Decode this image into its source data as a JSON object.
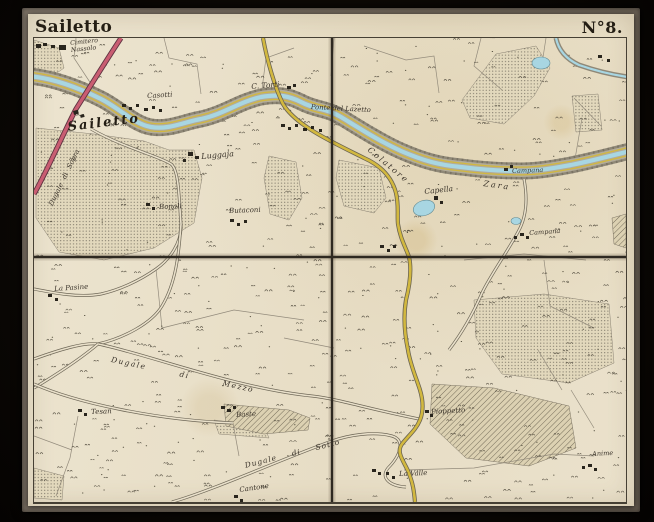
{
  "header": {
    "title": "Sailetto",
    "sheet_number": "N°8."
  },
  "map": {
    "colors": {
      "paper": "#e9e0ca",
      "water": "#a8d6e2",
      "main_road": "#c95d72",
      "secondary_road": "#d2b83f",
      "embankment": "#8f8877",
      "ink": "#3a332a",
      "frame": "#6d6357",
      "background": "#090704"
    },
    "labels": [
      {
        "id": "cimitero-nassolo",
        "text": "Cimitero\nNassolo",
        "x": 36,
        "y": 3,
        "size": 6.3,
        "rot": -6
      },
      {
        "id": "casotti",
        "text": "Casotti",
        "x": 113,
        "y": 55,
        "size": 7,
        "rot": -3
      },
      {
        "id": "c-torti",
        "text": "C. Torti",
        "x": 217,
        "y": 45,
        "size": 7.5,
        "rot": -5
      },
      {
        "id": "ponte-del-lazetto",
        "text": "Ponte del Lazetto",
        "x": 277,
        "y": 66,
        "size": 6.8,
        "rot": 3
      },
      {
        "id": "sailetto-town",
        "text": "Sailetto",
        "x": 33,
        "y": 83,
        "size": 13,
        "rot": -7,
        "bold": true,
        "ls": 2
      },
      {
        "id": "dugale-di-sopra",
        "text": "Dugale di Sopra",
        "x": 14,
        "y": 166,
        "size": 6.8,
        "rot": -64,
        "ws": 3
      },
      {
        "id": "luggaja",
        "text": "Luggaja",
        "x": 167,
        "y": 115,
        "size": 8,
        "rot": -5
      },
      {
        "id": "bonali",
        "text": "Bonali",
        "x": 125,
        "y": 166,
        "size": 7,
        "rot": -2
      },
      {
        "id": "butaconi",
        "text": "Butaconi",
        "x": 195,
        "y": 170,
        "size": 7,
        "rot": -2
      },
      {
        "id": "colatore",
        "text": "Colatore",
        "x": 337,
        "y": 108,
        "size": 8,
        "rot": 40,
        "ls": 2
      },
      {
        "id": "zara",
        "text": "Zara",
        "x": 450,
        "y": 142,
        "size": 8,
        "rot": 8,
        "ls": 2
      },
      {
        "id": "capella",
        "text": "Capella",
        "x": 390,
        "y": 150,
        "size": 7.5,
        "rot": -6
      },
      {
        "id": "campana-north",
        "text": "Campana",
        "x": 478,
        "y": 130,
        "size": 6.5,
        "rot": -2
      },
      {
        "id": "campana-south",
        "text": "Campana",
        "x": 495,
        "y": 192,
        "size": 6.5,
        "rot": -4
      },
      {
        "id": "la-pasine",
        "text": "La Pasine",
        "x": 20,
        "y": 248,
        "size": 7,
        "rot": -4
      },
      {
        "id": "dugale-di-mezzo",
        "text": "Dugale di Mezzo",
        "x": 78,
        "y": 318,
        "size": 7.5,
        "rot": 12,
        "ws": 30,
        "ls": 1.5
      },
      {
        "id": "tesan",
        "text": "Tesan",
        "x": 57,
        "y": 371,
        "size": 7,
        "rot": -2
      },
      {
        "id": "baste",
        "text": "Baste",
        "x": 202,
        "y": 374,
        "size": 7,
        "rot": -3
      },
      {
        "id": "pioppetto",
        "text": "Pioppetto",
        "x": 397,
        "y": 371,
        "size": 7,
        "rot": -3
      },
      {
        "id": "la-valle",
        "text": "La Valle",
        "x": 365,
        "y": 433,
        "size": 7,
        "rot": -2
      },
      {
        "id": "anime",
        "text": "Anime",
        "x": 558,
        "y": 413,
        "size": 6.5,
        "rot": -3
      },
      {
        "id": "cantone",
        "text": "Cantone",
        "x": 205,
        "y": 449,
        "size": 7,
        "rot": -8
      },
      {
        "id": "dugale-di-sotto",
        "text": "Dugale di Sotto",
        "x": 210,
        "y": 424,
        "size": 7.5,
        "rot": -14,
        "ws": 12,
        "ls": 1
      }
    ],
    "buildings": [
      [
        2,
        6,
        5,
        4,
        0
      ],
      [
        9,
        5,
        4,
        3,
        0
      ],
      [
        17,
        7,
        4,
        3,
        0
      ],
      [
        25,
        7,
        7,
        5,
        0
      ],
      [
        39,
        73,
        5,
        4,
        -15
      ],
      [
        46,
        77,
        4,
        3,
        -15
      ],
      [
        88,
        66,
        4,
        3,
        0
      ],
      [
        95,
        69,
        3,
        3,
        0
      ],
      [
        102,
        66,
        3,
        3,
        0
      ],
      [
        110,
        70,
        4,
        3,
        0
      ],
      [
        118,
        68,
        3,
        3,
        0
      ],
      [
        125,
        71,
        3,
        3,
        0
      ],
      [
        247,
        86,
        4,
        3,
        0
      ],
      [
        254,
        89,
        3,
        3,
        0
      ],
      [
        261,
        86,
        3,
        3,
        0
      ],
      [
        269,
        90,
        4,
        3,
        0
      ],
      [
        277,
        88,
        3,
        3,
        0
      ],
      [
        285,
        91,
        3,
        3,
        0
      ],
      [
        253,
        48,
        4,
        3,
        0
      ],
      [
        259,
        46,
        3,
        3,
        0
      ],
      [
        154,
        114,
        5,
        4,
        0
      ],
      [
        161,
        118,
        4,
        3,
        0
      ],
      [
        149,
        121,
        3,
        3,
        0
      ],
      [
        112,
        165,
        4,
        3,
        0
      ],
      [
        118,
        169,
        3,
        3,
        0
      ],
      [
        196,
        181,
        4,
        3,
        0
      ],
      [
        203,
        185,
        3,
        3,
        0
      ],
      [
        210,
        182,
        3,
        3,
        0
      ],
      [
        400,
        158,
        4,
        4,
        0
      ],
      [
        406,
        163,
        3,
        3,
        0
      ],
      [
        470,
        130,
        4,
        3,
        0
      ],
      [
        476,
        127,
        3,
        3,
        0
      ],
      [
        486,
        195,
        4,
        3,
        0
      ],
      [
        492,
        198,
        3,
        3,
        0
      ],
      [
        480,
        198,
        3,
        3,
        0
      ],
      [
        14,
        256,
        4,
        3,
        0
      ],
      [
        21,
        260,
        3,
        3,
        0
      ],
      [
        44,
        371,
        4,
        3,
        0
      ],
      [
        50,
        375,
        3,
        3,
        0
      ],
      [
        187,
        368,
        4,
        3,
        0
      ],
      [
        193,
        371,
        4,
        3,
        0
      ],
      [
        199,
        368,
        3,
        3,
        0
      ],
      [
        391,
        372,
        4,
        3,
        0
      ],
      [
        396,
        376,
        3,
        3,
        0
      ],
      [
        338,
        431,
        4,
        3,
        0
      ],
      [
        344,
        434,
        3,
        3,
        0
      ],
      [
        352,
        434,
        3,
        3,
        0
      ],
      [
        358,
        438,
        3,
        3,
        0
      ],
      [
        554,
        426,
        4,
        3,
        0
      ],
      [
        560,
        430,
        3,
        3,
        0
      ],
      [
        548,
        428,
        3,
        3,
        0
      ],
      [
        200,
        457,
        4,
        3,
        0
      ],
      [
        206,
        461,
        3,
        3,
        0
      ],
      [
        346,
        207,
        4,
        3,
        0
      ],
      [
        353,
        211,
        3,
        3,
        0
      ],
      [
        359,
        207,
        3,
        3,
        0
      ],
      [
        564,
        17,
        4,
        3,
        0
      ],
      [
        573,
        21,
        3,
        3,
        0
      ]
    ]
  }
}
